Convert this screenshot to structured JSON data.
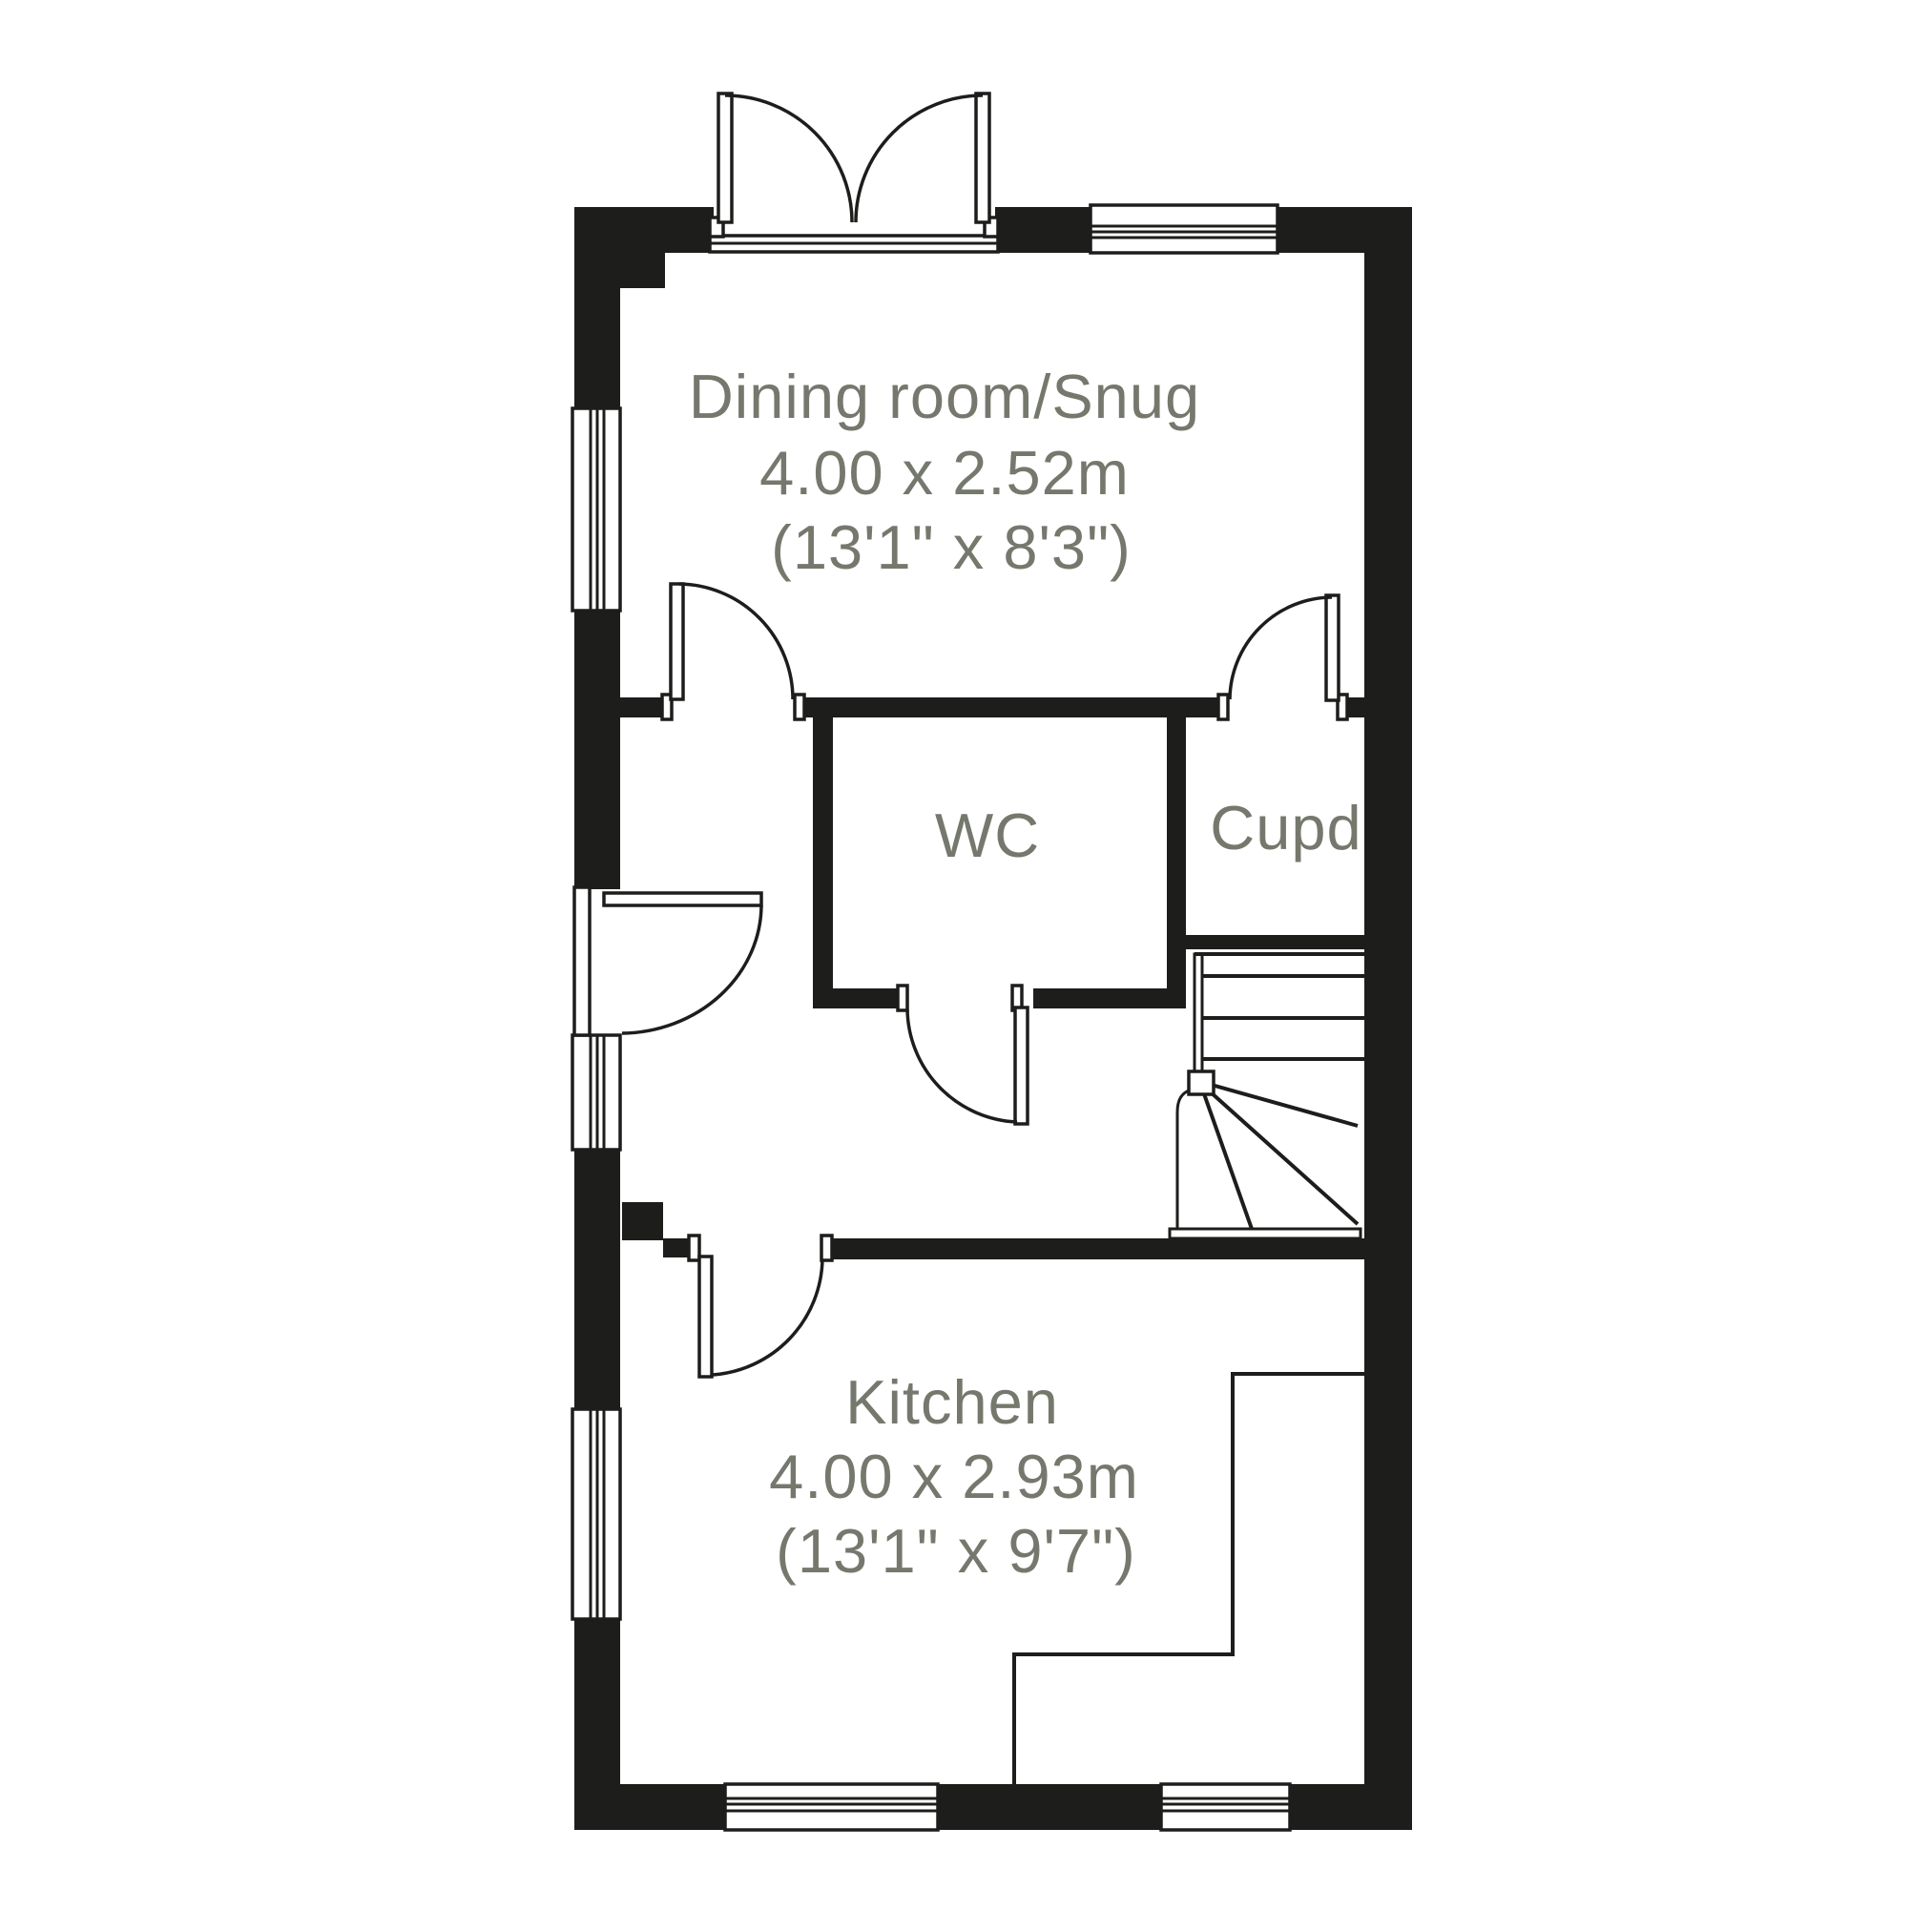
{
  "floorplan": {
    "colors": {
      "background": "#ffffff",
      "wall": "#1d1d1b",
      "label": "#75786d"
    },
    "rooms": [
      {
        "id": "dining",
        "name": "Dining room/Snug",
        "size_metric": "4.00 x 2.52m",
        "size_imperial": "(13'1\" x 8'3\")"
      },
      {
        "id": "wc",
        "name": "WC"
      },
      {
        "id": "cupboard",
        "name": "Cupd"
      },
      {
        "id": "kitchen",
        "name": "Kitchen",
        "size_metric": "4.00 x 2.93m",
        "size_imperial": "(13'1\" x 9'7\")"
      }
    ]
  }
}
